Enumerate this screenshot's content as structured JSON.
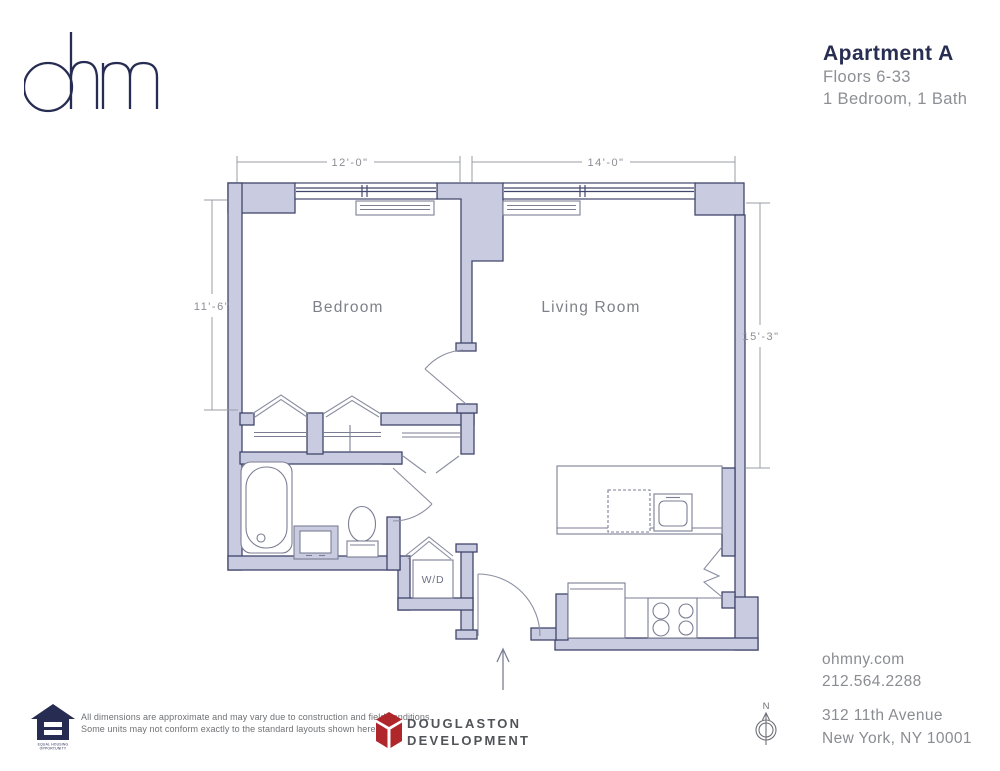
{
  "header": {
    "logo_text": "ohm",
    "apartment_title": "Apartment A",
    "floors": "Floors 6-33",
    "configuration": "1 Bedroom, 1 Bath"
  },
  "plan": {
    "room_labels": {
      "bedroom": "Bedroom",
      "living_room": "Living Room",
      "washer_dryer": "W/D"
    },
    "dimensions": {
      "bedroom_width": "12'-0\"",
      "living_room_width": "14'-0\"",
      "bedroom_depth": "11'-6\"",
      "living_room_depth": "15'-3\""
    }
  },
  "footer": {
    "equal_housing": {
      "line1": "EQUAL HOUSING",
      "line2": "OPPORTUNITY"
    },
    "disclaimer": {
      "line1": "All dimensions are approximate and may vary due to construction and field conditions.",
      "line2": "Some units may not conform exactly to the standard layouts shown herein."
    },
    "developer": {
      "line1": "DOUGLASTON",
      "line2": "DEVELOPMENT"
    },
    "compass_label": "N",
    "contact": {
      "website": "ohmny.com",
      "phone": "212.564.2288"
    },
    "address": {
      "line1": "312 11th Avenue",
      "line2": "New York, NY 10001"
    }
  },
  "colors": {
    "brand_navy": "#272c52",
    "wall_fill": "#c9cce0",
    "wall_stroke": "#41466b",
    "fixture_stroke": "#7b7e93",
    "label_gray": "#8b8d94",
    "developer_red": "#af272b"
  }
}
